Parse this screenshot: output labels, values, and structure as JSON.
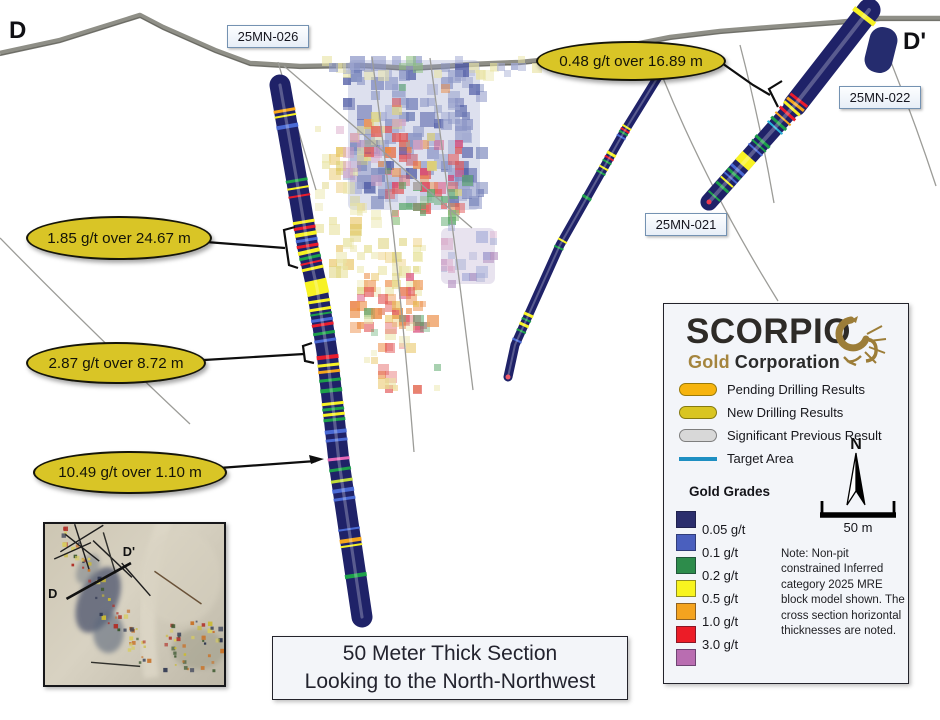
{
  "section": {
    "left_label": "D",
    "right_label": "D'"
  },
  "drill_labels": {
    "h026": "25MN-026",
    "h022": "25MN-022",
    "h021": "25MN-021"
  },
  "callouts": {
    "c1": "1.85 g/t over 24.67 m",
    "c2": "2.87 g/t over 8.72 m",
    "c3": "10.49 g/t over 1.10 m",
    "c4": "0.48 g/t over 16.89 m"
  },
  "caption": {
    "line1": "50 Meter Thick Section",
    "line2": "Looking to the North-Northwest"
  },
  "inset": {
    "start_label": "D",
    "end_label": "D'"
  },
  "legend": {
    "logo": {
      "name": "SCORPIO",
      "word1": "Gold",
      "word2": "Corporation",
      "accent": "#a5853e"
    },
    "items": [
      {
        "label": "Pending Drilling Results",
        "type": "pill",
        "fill": "#F6B40E",
        "stroke": "#9a7a08"
      },
      {
        "label": "New Drilling Results",
        "type": "pill",
        "fill": "#D9C521",
        "stroke": "#857a10"
      },
      {
        "label": "Significant Previous Result",
        "type": "pill",
        "fill": "#D8D8D8",
        "stroke": "#7e7e7e"
      },
      {
        "label": "Target Area",
        "type": "line",
        "fill": "#1E8FC2"
      }
    ],
    "gold_grades_title": "Gold Grades",
    "grades": [
      {
        "label": "0.05 g/t",
        "color": "#2B2E6D"
      },
      {
        "label": "0.1  g/t",
        "color": "#4A5FBE"
      },
      {
        "label": "0.2  g/t",
        "color": "#2D8C4B"
      },
      {
        "label": "0.5  g/t",
        "color": "#F8F41F"
      },
      {
        "label": "1.0  g/t",
        "color": "#F4A31F"
      },
      {
        "label": "3.0  g/t",
        "color": "#EC1C27"
      },
      {
        "label": "",
        "color": "#B96DB1"
      }
    ],
    "north_label": "N",
    "scale_label": "50 m",
    "note": "Note: Non-pit constrained Inferred category 2025 MRE block model shown. The cross section horizontal thicknesses are noted."
  },
  "geometry": {
    "topo": [
      [
        0,
        53
      ],
      [
        60,
        40
      ],
      [
        140,
        15
      ],
      [
        163,
        27
      ],
      [
        215,
        50
      ],
      [
        250,
        63
      ],
      [
        300,
        66
      ],
      [
        360,
        65
      ],
      [
        410,
        68
      ],
      [
        445,
        66
      ],
      [
        470,
        64
      ],
      [
        520,
        62
      ],
      [
        570,
        57
      ],
      [
        620,
        47
      ],
      [
        670,
        37
      ],
      [
        720,
        31
      ],
      [
        770,
        27
      ],
      [
        837,
        22
      ],
      [
        880,
        18
      ],
      [
        940,
        18
      ]
    ],
    "trace_lines": [
      "M0,238 Q90,330 190,424",
      "M278,62 L316,190",
      "M284,66 L472,228",
      "M372,57 Q398,250 414,452",
      "M430,58 Q452,220 473,390",
      "M740,45 Q760,122 774,203",
      "M663,78 Q708,188 778,301",
      "M889,57 Q915,122 936,186"
    ],
    "bases": [
      [
        348,
        60,
        132,
        150,
        "#98a2cc",
        0.33
      ],
      [
        441,
        228,
        54,
        56,
        "#b9a8cc",
        0.32
      ]
    ],
    "clusters": [
      [
        336,
        58,
        150,
        152,
        120,
        8,
        16,
        0.4,
        0.75,
        [
          "#8c96c6",
          "#6a78b4",
          "#a2aad2",
          "#4a56a2",
          "#8c96c6"
        ]
      ],
      [
        318,
        57,
        228,
        22,
        34,
        6,
        11,
        0.35,
        0.65,
        [
          "#e9e4a4",
          "#8cc07c",
          "#a2aad2",
          "#e9e4a4",
          "#8c96c6"
        ]
      ],
      [
        315,
        112,
        68,
        122,
        40,
        6,
        12,
        0.4,
        0.7,
        [
          "#e9e4a4",
          "#e9e4a4",
          "#ddd27a",
          "#e8c25c"
        ]
      ],
      [
        337,
        110,
        46,
        78,
        14,
        7,
        12,
        0.35,
        0.6,
        [
          "#d8a0c4",
          "#b490c0",
          "#d8a0c4"
        ]
      ],
      [
        378,
        138,
        88,
        78,
        42,
        6,
        12,
        0.42,
        0.78,
        [
          "#e25858",
          "#ec8c44",
          "#d84878",
          "#e25858"
        ]
      ],
      [
        388,
        190,
        72,
        36,
        18,
        6,
        11,
        0.42,
        0.72,
        [
          "#5aa86a",
          "#8cc07c",
          "#5aa86a"
        ]
      ],
      [
        328,
        226,
        96,
        76,
        48,
        6,
        12,
        0.36,
        0.66,
        [
          "#e9e4a4",
          "#ddd27a",
          "#e9e4a4",
          "#e8c25c"
        ]
      ],
      [
        350,
        270,
        82,
        66,
        36,
        6,
        12,
        0.42,
        0.72,
        [
          "#ec8c44",
          "#e25858",
          "#d84878",
          "#ec8c44"
        ]
      ],
      [
        440,
        226,
        58,
        60,
        22,
        6,
        12,
        0.36,
        0.66,
        [
          "#b490c0",
          "#9aa4d4",
          "#d8a0c4",
          "#a2aad2"
        ]
      ],
      [
        356,
        298,
        84,
        96,
        40,
        6,
        12,
        0.36,
        0.68,
        [
          "#e9e4a4",
          "#e8c25c",
          "#e25858",
          "#5aa86a",
          "#ec8c44"
        ]
      ],
      [
        360,
        80,
        120,
        120,
        30,
        6,
        11,
        0.45,
        0.78,
        [
          "#e25858",
          "#ec8c44",
          "#5aa86a",
          "#ddd27a",
          "#4a56a2",
          "#d8a0c4"
        ]
      ]
    ],
    "drills": [
      {
        "name": "25MN-026",
        "width": 21,
        "pts": [
          [
            280,
            85
          ],
          [
            296,
            176
          ],
          [
            308,
            248
          ],
          [
            317,
            288
          ],
          [
            327,
            352
          ],
          [
            339,
            462
          ],
          [
            362,
            617
          ]
        ],
        "bands": [
          [
            0.048,
            3,
            "o"
          ],
          [
            0.058,
            2,
            "y"
          ],
          [
            0.078,
            4,
            "b"
          ],
          [
            0.18,
            3,
            "g"
          ],
          [
            0.194,
            2,
            "y"
          ],
          [
            0.209,
            2,
            "r"
          ],
          [
            0.258,
            3,
            "y"
          ],
          [
            0.269,
            3,
            "r"
          ],
          [
            0.281,
            4,
            "y"
          ],
          [
            0.292,
            3,
            "b"
          ],
          [
            0.303,
            3,
            "r"
          ],
          [
            0.314,
            4,
            "y"
          ],
          [
            0.325,
            3,
            "g"
          ],
          [
            0.335,
            2,
            "r"
          ],
          [
            0.346,
            3,
            "y"
          ],
          [
            0.382,
            15,
            "y"
          ],
          [
            0.408,
            3,
            "y"
          ],
          [
            0.423,
            3,
            "y"
          ],
          [
            0.432,
            2,
            "g"
          ],
          [
            0.443,
            3,
            "b"
          ],
          [
            0.452,
            3,
            "r"
          ],
          [
            0.468,
            3,
            "g"
          ],
          [
            0.482,
            3,
            "b"
          ],
          [
            0.513,
            4,
            "r"
          ],
          [
            0.528,
            3,
            "y"
          ],
          [
            0.54,
            3,
            "o"
          ],
          [
            0.556,
            3,
            "g"
          ],
          [
            0.575,
            4,
            "g"
          ],
          [
            0.6,
            3,
            "y"
          ],
          [
            0.61,
            3,
            "g"
          ],
          [
            0.62,
            3,
            "y"
          ],
          [
            0.63,
            3,
            "g"
          ],
          [
            0.652,
            4,
            "b"
          ],
          [
            0.668,
            3,
            "b"
          ],
          [
            0.703,
            3,
            "p"
          ],
          [
            0.723,
            3,
            "g"
          ],
          [
            0.744,
            3,
            "yg"
          ],
          [
            0.762,
            4,
            "b"
          ],
          [
            0.778,
            3,
            "b"
          ],
          [
            0.835,
            2,
            "b"
          ],
          [
            0.856,
            4,
            "o"
          ],
          [
            0.866,
            2,
            "y"
          ],
          [
            0.922,
            4,
            "g"
          ]
        ]
      },
      {
        "name": "25MN-021",
        "width": 9,
        "pts": [
          [
            661,
            72
          ],
          [
            624,
            132
          ],
          [
            560,
            245
          ],
          [
            515,
            345
          ],
          [
            508,
            377
          ]
        ],
        "bands": [
          [
            0.19,
            2,
            "y"
          ],
          [
            0.2,
            2,
            "r"
          ],
          [
            0.209,
            2,
            "g"
          ],
          [
            0.222,
            2,
            "b"
          ],
          [
            0.28,
            3,
            "y"
          ],
          [
            0.293,
            2,
            "r"
          ],
          [
            0.306,
            2,
            "g"
          ],
          [
            0.326,
            2,
            "y"
          ],
          [
            0.342,
            2,
            "g"
          ],
          [
            0.426,
            3,
            "g"
          ],
          [
            0.57,
            2,
            "y"
          ],
          [
            0.593,
            2,
            "g"
          ],
          [
            0.808,
            3,
            "y"
          ],
          [
            0.824,
            2,
            "g"
          ],
          [
            0.84,
            3,
            "y"
          ],
          [
            0.86,
            2,
            "g"
          ],
          [
            0.89,
            2,
            "b"
          ]
        ],
        "tip": "#f05a6a"
      },
      {
        "name": "25MN-022",
        "width": 26,
        "width_end": 14,
        "pts": [
          [
            869,
            10
          ],
          [
            795,
            105
          ],
          [
            709,
            202
          ]
        ],
        "bands": [
          [
            0.032,
            5,
            "y"
          ],
          [
            0.457,
            3,
            "r"
          ],
          [
            0.478,
            3,
            "o"
          ],
          [
            0.5,
            3,
            "y"
          ],
          [
            0.527,
            3,
            "r"
          ],
          [
            0.554,
            2,
            "o"
          ],
          [
            0.58,
            3,
            "g"
          ],
          [
            0.602,
            2,
            "t"
          ],
          [
            0.677,
            3,
            "g"
          ],
          [
            0.699,
            2,
            "g"
          ],
          [
            0.72,
            2,
            "b"
          ],
          [
            0.78,
            11,
            "y"
          ],
          [
            0.828,
            3,
            "b"
          ],
          [
            0.85,
            3,
            "g"
          ],
          [
            0.87,
            2,
            "b"
          ],
          [
            0.892,
            2,
            "y"
          ],
          [
            0.92,
            3,
            "g"
          ],
          [
            0.968,
            2,
            "g"
          ]
        ],
        "tip": "#ee3a50"
      }
    ],
    "stub": {
      "x": 881,
      "y": 50,
      "w": 28,
      "h": 46,
      "rot": 14
    },
    "annotations": {
      "connectors": [
        "M206,242 L285,248",
        "M204,360 L304,354",
        "M219,468 L316,461",
        "M719,61 L753,85 L770,95"
      ],
      "brackets": [
        "M295,227 L284,230 L289,265 L298,268",
        "M312,343 L303,346 L305,361 L314,363",
        "M782,81 L769,89 L778,107"
      ],
      "arrowhead": "M324,459 L309,455 L311,464 Z"
    },
    "inset_lines": [
      [
        15,
        27,
        57,
        1,
        "#1e1e1e"
      ],
      [
        20,
        10,
        53,
        36,
        "#1e1e1e"
      ],
      [
        29,
        0,
        43,
        44,
        "#1e1e1e"
      ],
      [
        47,
        16,
        85,
        52,
        "#1e1e1e"
      ],
      [
        9,
        34,
        45,
        18,
        "#1e1e1e"
      ],
      [
        57,
        8,
        69,
        48,
        "#30302c"
      ],
      [
        45,
        135,
        93,
        139,
        "#30302c"
      ],
      [
        75,
        38,
        103,
        70,
        "#1e1e1e"
      ],
      [
        107,
        46,
        153,
        78,
        "#6a5238"
      ]
    ]
  }
}
